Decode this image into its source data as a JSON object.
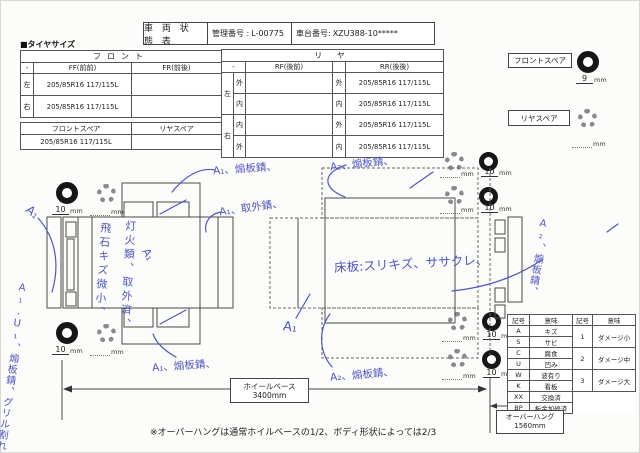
{
  "header": {
    "title": "車 両 状 態 表",
    "mgmt_label": "管理番号 :",
    "mgmt_value": "L-00775",
    "chassis_label": "車台番号:",
    "chassis_value": "XZU388-10*****"
  },
  "tire": {
    "section_label": "■タイヤサイズ",
    "front": {
      "title": "フロント",
      "corner": "-",
      "col_ff": "FF(前前)",
      "col_fr": "FR(前後)",
      "rows": [
        {
          "side": "左",
          "ff": "205/85R16 117/115L",
          "fr": ""
        },
        {
          "side": "右",
          "ff": "205/85R16 117/115L",
          "fr": ""
        }
      ]
    },
    "spare": {
      "col_front": "フロントスペア",
      "col_rear": "リヤスペア",
      "front_value": "205/85R16 117/115L",
      "rear_value": ""
    },
    "rear": {
      "title": "リ ヤ",
      "corner": "-",
      "col_rf": "RF(後前)",
      "col_rr": "RR(後後)",
      "rows": [
        {
          "group": "左",
          "pos": "外",
          "rf": "",
          "rr_pos": "外",
          "rr": "205/85R16 117/115L"
        },
        {
          "pos": "内",
          "rf": "",
          "rr_pos": "内",
          "rr": "205/85R16 117/115L"
        },
        {
          "group": "右",
          "pos": "内",
          "rf": "",
          "rr_pos": "外",
          "rr": "205/85R16 117/115L"
        },
        {
          "pos": "外",
          "rf": "",
          "rr_pos": "内",
          "rr": "205/85R16 117/115L"
        }
      ]
    }
  },
  "spares": {
    "front_label": "フロントスペア",
    "front_depth": "9",
    "rear_label": "リヤスペア",
    "rear_depth": "",
    "unit": "mm"
  },
  "tread": {
    "unit": "mm",
    "values_10": [
      "10",
      "10",
      "10",
      "10",
      "10",
      "10"
    ]
  },
  "annotations": {
    "a1_top": "A₁、煽板錆、",
    "a1_right": "A₁、取外錆、",
    "a1_left": "A₁",
    "stone_chips": "飛石キズ微小、",
    "lights_removed": "灯火類、取外済、",
    "a1_center": "A₁",
    "left_margin": "A₁.U₁、煽板錆、グリル割れ",
    "a1_bottom": "A₁、煽板錆、",
    "a2_top": "A₂、煽板錆、",
    "floor_note": "床板:スリキズ、ササクレ、",
    "a1_mid": "A₁",
    "a2_bottom": "A₂、煽板錆、",
    "a2_margin": "A₂、煽板錆、"
  },
  "legend": {
    "h_symbol": "記号",
    "h_meaning": "意味",
    "rows": [
      {
        "sym": "A",
        "mean": "キズ"
      },
      {
        "sym": "S",
        "mean": "サビ"
      },
      {
        "sym": "C",
        "mean": "腐食"
      },
      {
        "sym": "U",
        "mean": "凹み"
      },
      {
        "sym": "W",
        "mean": "波有り"
      },
      {
        "sym": "K",
        "mean": "看板"
      },
      {
        "sym": "XX",
        "mean": "交換済"
      },
      {
        "sym": "BP",
        "mean": "板金加修済"
      }
    ],
    "damage_rows": [
      {
        "sym": "1",
        "mean": "ダメージ小"
      },
      {
        "sym": "2",
        "mean": "ダメージ中"
      },
      {
        "sym": "3",
        "mean": "ダメージ大"
      }
    ]
  },
  "dimensions": {
    "wheelbase_label": "ホイールベース",
    "wheelbase_value": "3400mm",
    "overhang_label": "オーバーハング",
    "overhang_value": "1560mm"
  },
  "footnote": "※オーバーハングは通常ホイルベースの1/2、ボディ形状によっては2/3",
  "colors": {
    "ink_blue": "#5055c5",
    "line_black": "#444444"
  }
}
